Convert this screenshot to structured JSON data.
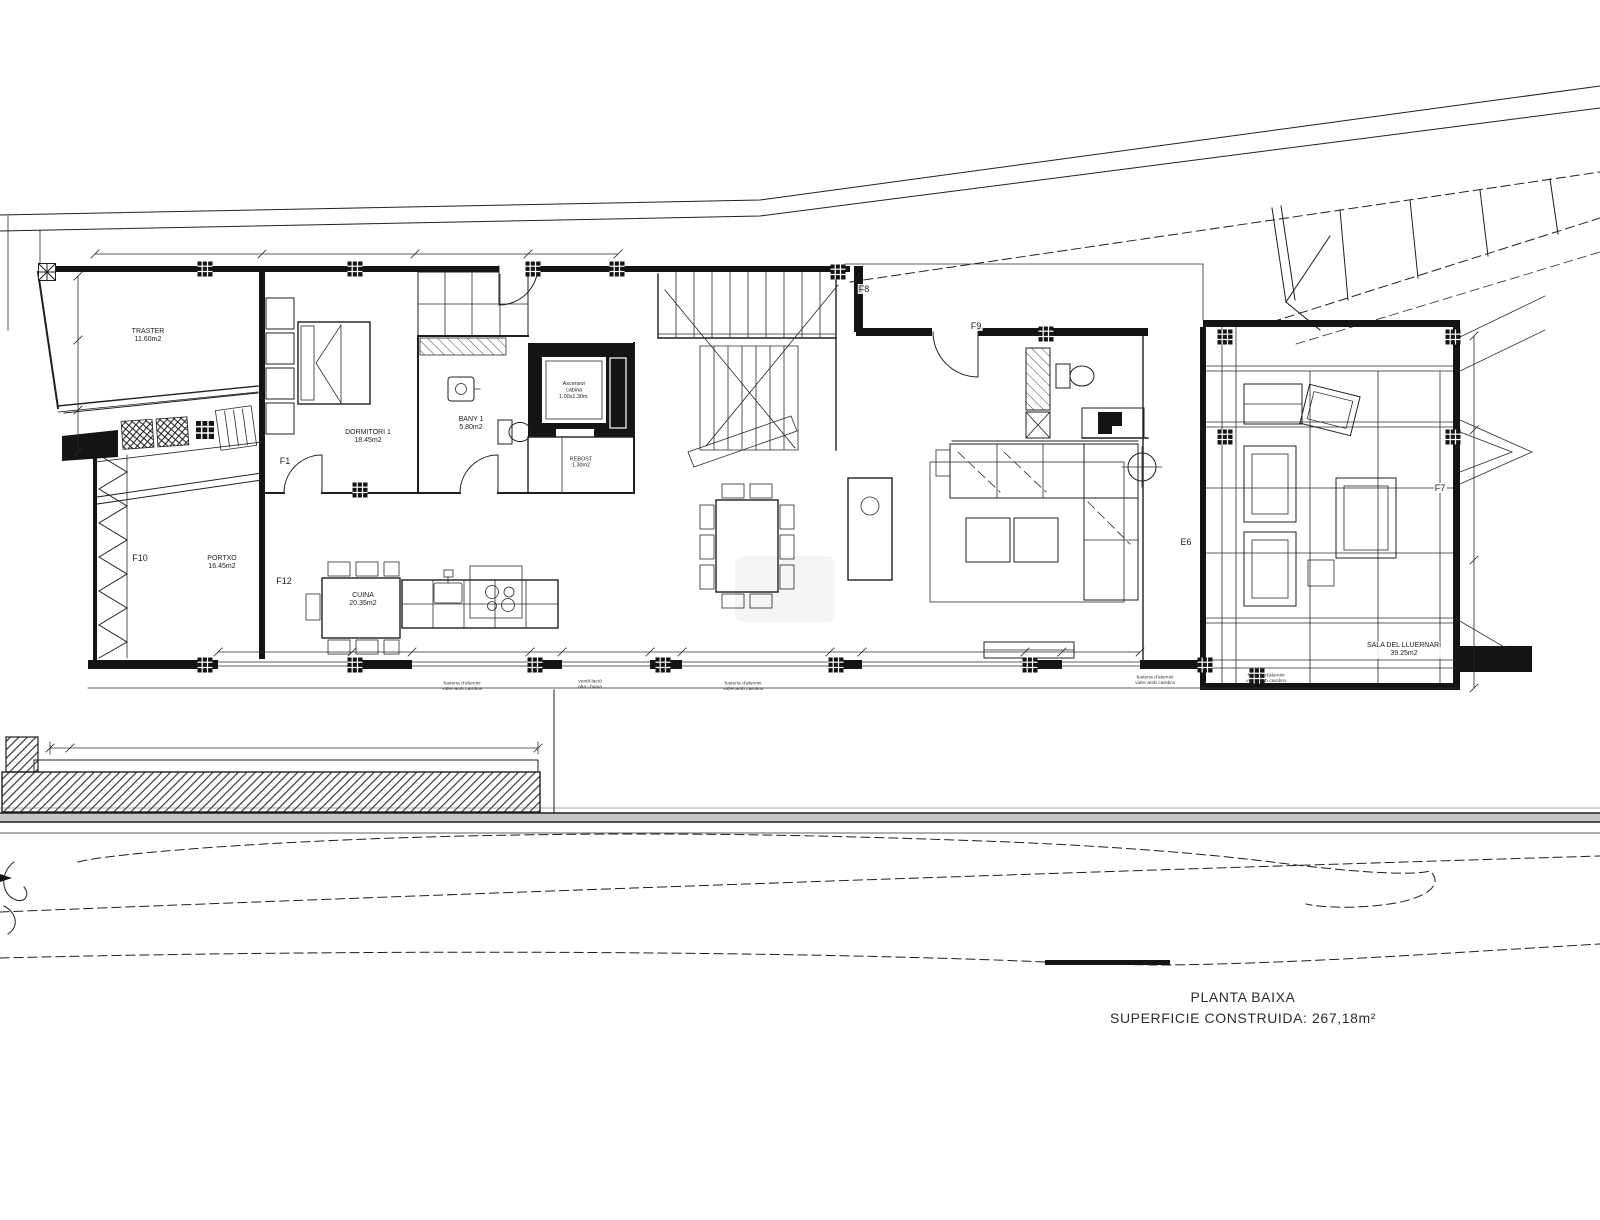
{
  "plan": {
    "title": "PLANTA BAIXA",
    "subtitle": "SUPERFICIE CONSTRUIDA: 267,18m²"
  },
  "rooms": {
    "traster": {
      "name": "TRASTER",
      "area": "11.60m2"
    },
    "dormitori": {
      "name": "DORMITORI 1",
      "area": "18.45m2"
    },
    "bany": {
      "name": "BANY 1",
      "area": "5.80m2"
    },
    "ascensor": {
      "l1": "Ascensor",
      "l2": "cabina",
      "l3": "1.00x1.30m."
    },
    "rebost": {
      "name": "REBOST",
      "area": "1.30m2"
    },
    "portxo": {
      "name": "PORTXO",
      "area": "16.45m2"
    },
    "cuina": {
      "name": "CUINA",
      "area": "20.35m2"
    },
    "sala": {
      "name": "SALA DEL LLUERNARI",
      "area": "39.25m2"
    }
  },
  "openings": {
    "f1": "F1",
    "f7": "F7",
    "f8": "F8",
    "f9": "F9",
    "f10": "F10",
    "f12": "F12",
    "e6": "E6"
  },
  "notes": {
    "n1": {
      "l1": "fusteria d'alumini",
      "l2": "vidre amb cambra"
    },
    "n2": {
      "l1": "ventil·lació",
      "l2": "alta i baixa"
    },
    "n3": {
      "l1": "fusteria d'alumini",
      "l2": "vidre amb cambra"
    },
    "n4": {
      "l1": "fusteria d'alumini",
      "l2": "vidre amb cambra"
    },
    "n5": {
      "l1": "fusteria d'alumini",
      "l2": "vidre amb cambra"
    }
  }
}
